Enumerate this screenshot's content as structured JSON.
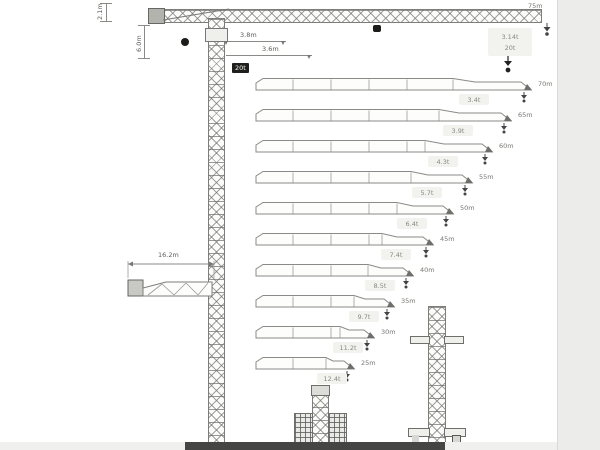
{
  "page": {
    "surround_color": "#ececea",
    "bottom_bar_color": "#454543"
  },
  "top_view": {
    "jib_length_label": "75m",
    "tip_load_box": {
      "line1": "3.14t",
      "line2": "20t"
    },
    "max_load_chip": "20t",
    "dims": {
      "head_height": "2.1m",
      "tower_top": "6.0m",
      "inner_a": "3.8m",
      "inner_b": "3.6m"
    }
  },
  "counter_jib_detail": {
    "dim_label": "16.2m"
  },
  "configs": [
    {
      "length": "70m",
      "tip_load": "3.4t"
    },
    {
      "length": "65m",
      "tip_load": "3.9t"
    },
    {
      "length": "60m",
      "tip_load": "4.3t"
    },
    {
      "length": "55m",
      "tip_load": "5.7t"
    },
    {
      "length": "50m",
      "tip_load": "6.4t"
    },
    {
      "length": "45m",
      "tip_load": "7.4t"
    },
    {
      "length": "40m",
      "tip_load": "8.5t"
    },
    {
      "length": "35m",
      "tip_load": "9.7t"
    },
    {
      "length": "30m",
      "tip_load": "11.2t"
    },
    {
      "length": "25m",
      "tip_load": "12.4t"
    }
  ]
}
